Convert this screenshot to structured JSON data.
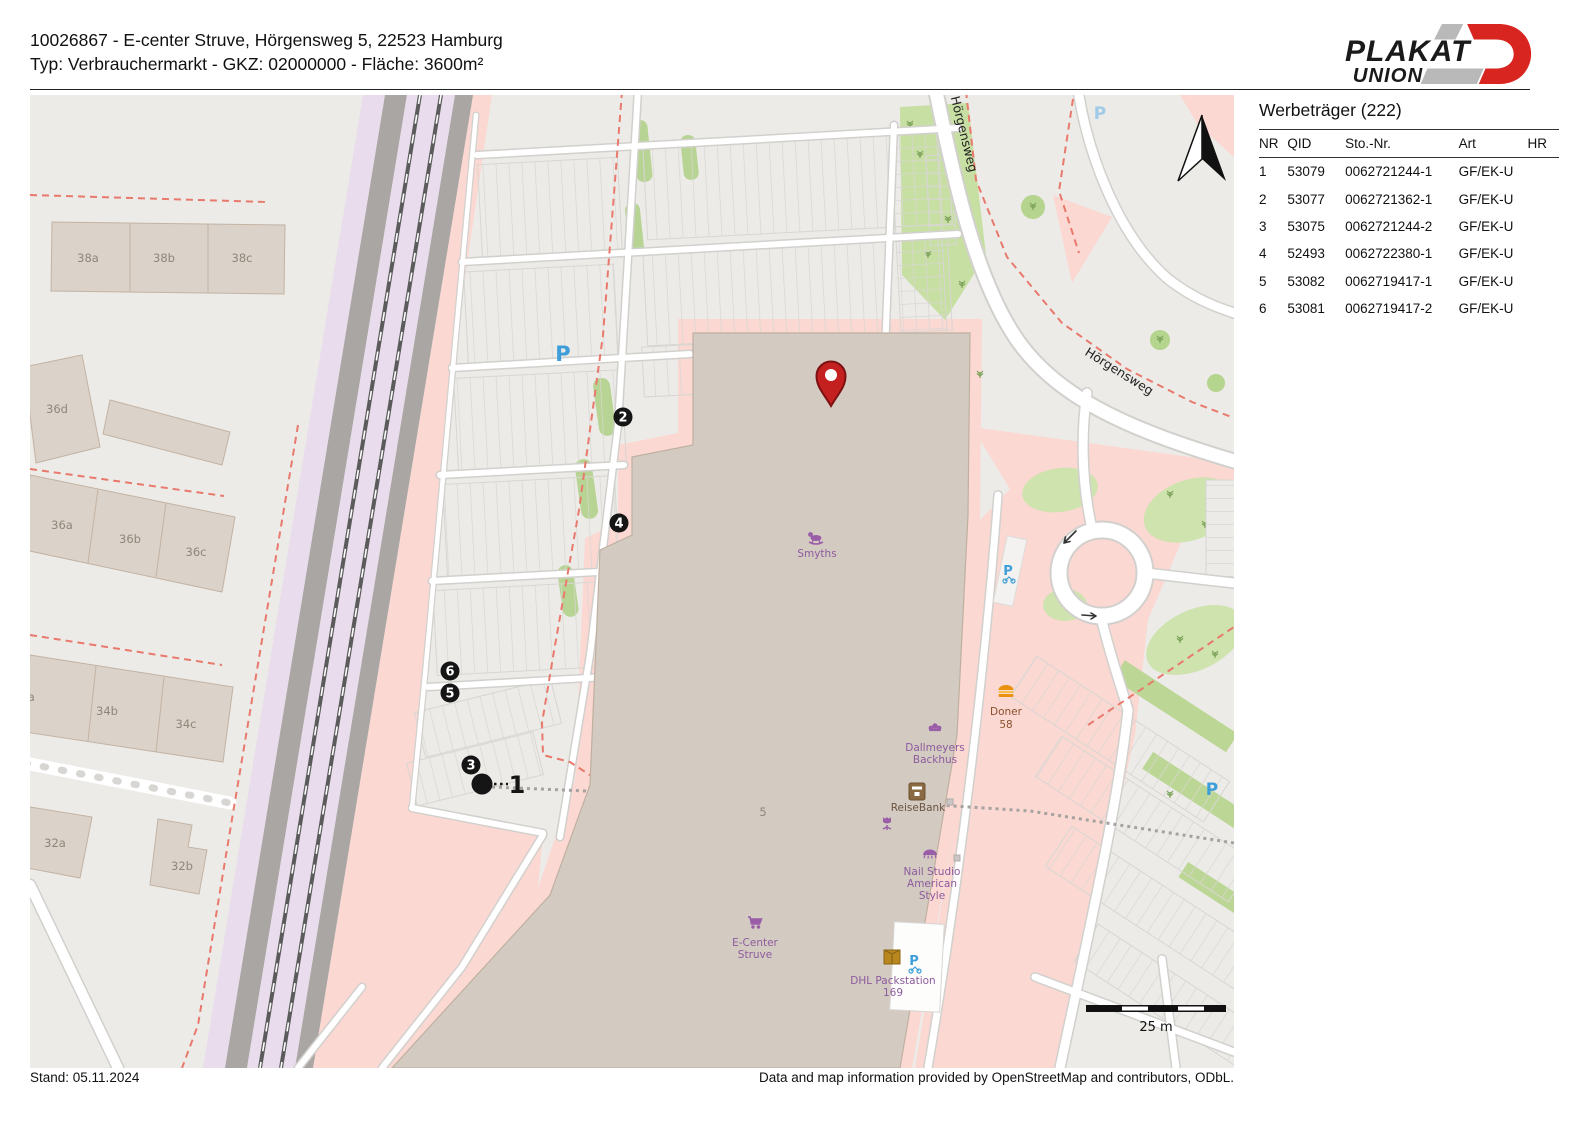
{
  "header": {
    "line1": "10026867 - E-center Struve, Hörgensweg 5, 22523 Hamburg",
    "line2": "Typ: Verbrauchermarkt - GKZ: 02000000 - Fläche: 3600m²"
  },
  "logo": {
    "word1": "PLAKAT",
    "word2": "UNION",
    "red": "#d9251f",
    "gray": "#b9b9b9"
  },
  "panel": {
    "title": "Werbeträger (222)",
    "columns": [
      "NR",
      "QID",
      "Sto.-Nr.",
      "Art",
      "HR"
    ],
    "rows": [
      {
        "nr": "1",
        "qid": "53079",
        "sto": "0062721244-1",
        "art": "GF/EK-U",
        "hr": ""
      },
      {
        "nr": "2",
        "qid": "53077",
        "sto": "0062721362-1",
        "art": "GF/EK-U",
        "hr": ""
      },
      {
        "nr": "3",
        "qid": "53075",
        "sto": "0062721244-2",
        "art": "GF/EK-U",
        "hr": ""
      },
      {
        "nr": "4",
        "qid": "52493",
        "sto": "0062722380-1",
        "art": "GF/EK-U",
        "hr": ""
      },
      {
        "nr": "5",
        "qid": "53082",
        "sto": "0062719417-1",
        "art": "GF/EK-U",
        "hr": ""
      },
      {
        "nr": "6",
        "qid": "53081",
        "sto": "0062719417-2",
        "art": "GF/EK-U",
        "hr": ""
      }
    ]
  },
  "map": {
    "street_label_top": "Hörgensweg",
    "street_label_main": "Hörgensweg",
    "parking_p_large": "P",
    "parking_p_top": "P",
    "parking_p_bottom": "P",
    "parking_p_bike1": "P",
    "parking_p_bike2": "P",
    "scale_label": "25 m",
    "house_number": "5",
    "buildings": {
      "b38a": "38a",
      "b38b": "38b",
      "b38c": "38c",
      "b36d": "36d",
      "b36a": "36a",
      "b36b": "36b",
      "b36c": "36c",
      "b34a": "34a",
      "b34b": "34b",
      "b34c": "34c",
      "b32a": "32a",
      "b32b": "32b"
    },
    "pois": {
      "smyths": "Smyths",
      "dallmeyers_1": "Dallmeyers",
      "dallmeyers_2": "Backhus",
      "reisebank": "ReiseBank",
      "nail_1": "Nail Studio",
      "nail_2": "American",
      "nail_3": "Style",
      "ecenter_1": "E-Center",
      "ecenter_2": "Struve",
      "dhl_1": "DHL Packstation",
      "dhl_2": "169",
      "doner_1": "Doner",
      "doner_2": "58"
    },
    "markers": {
      "m1": "1",
      "m2": "2",
      "m3": "3",
      "m4": "4",
      "m5": "5",
      "m6": "6"
    },
    "colors": {
      "pin_red": "#c42020",
      "marker_black": "#151515",
      "osm_purple": "#8d5a9e",
      "parking_blue": "#3d9ed9",
      "retail_pink": "#fbd8d2",
      "dash_red": "#e8796c"
    }
  },
  "footer": {
    "stand": "Stand: 05.11.2024",
    "attribution": "Data and map information provided by OpenStreetMap and contributors, ODbL."
  }
}
